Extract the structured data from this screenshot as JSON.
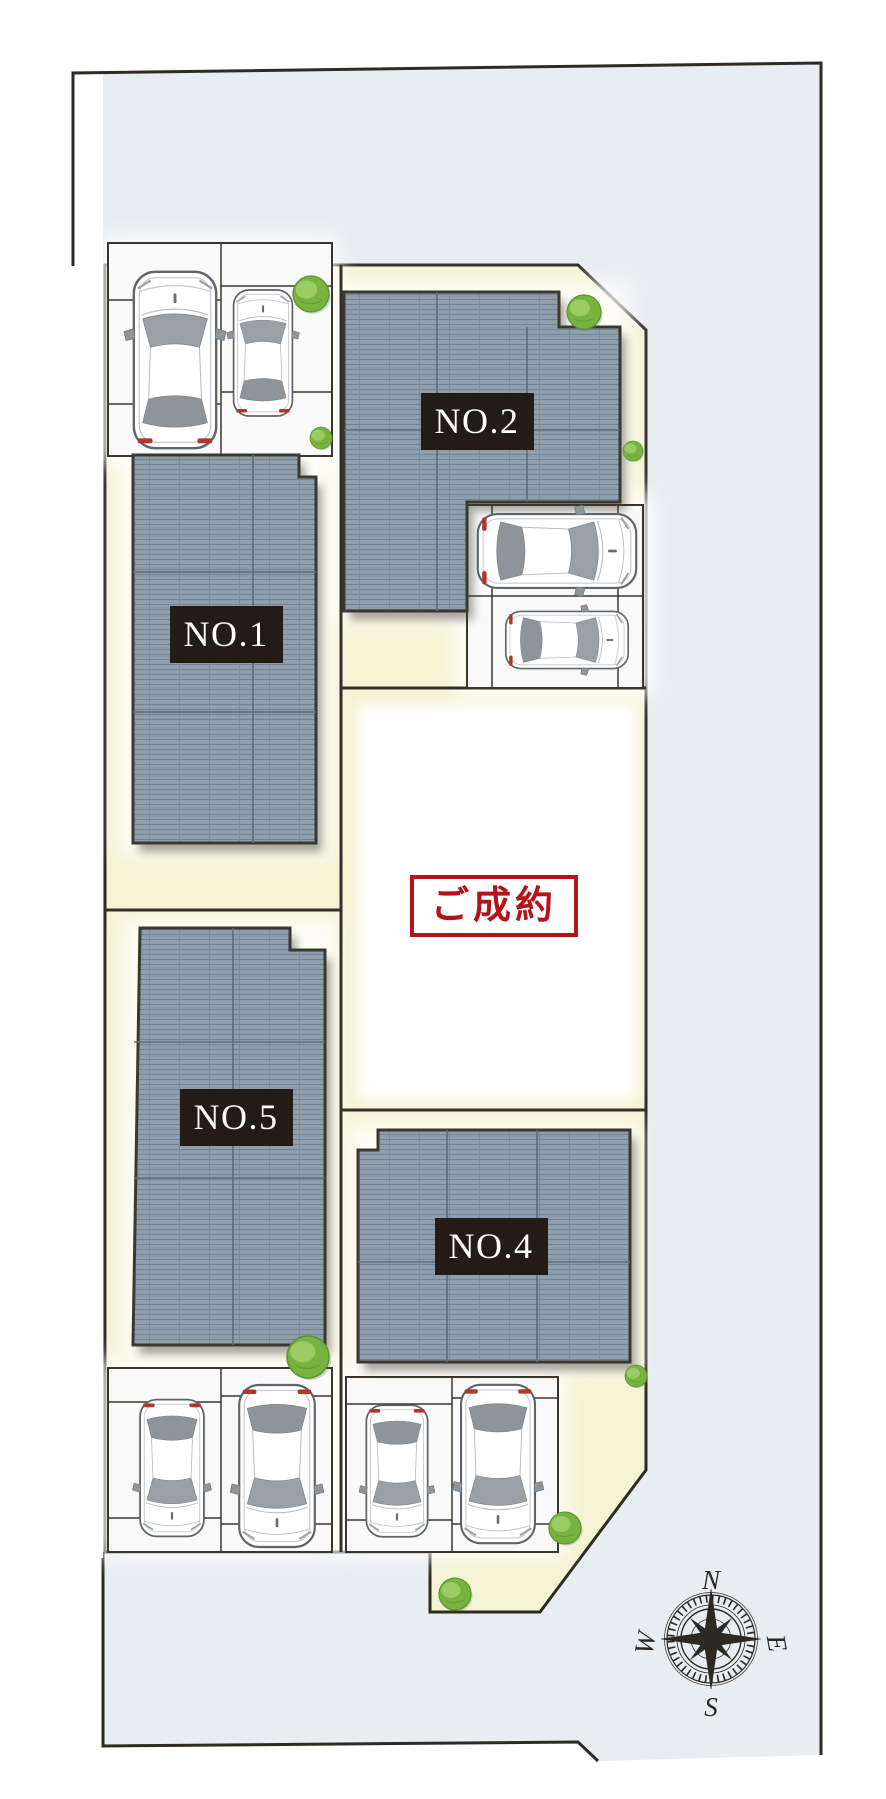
{
  "plan": {
    "lot_labels": {
      "no1": "NO.1",
      "no2": "NO.2",
      "no4": "NO.4",
      "no5": "NO.5"
    },
    "sold_label": "ご成約",
    "compass": {
      "north": "N",
      "south": "S",
      "east": "E",
      "west": "W"
    }
  },
  "colors": {
    "road": "#e8edf1",
    "site_ground": "#f4f3d4",
    "roof": "#8e9eac",
    "boundary": "#2e2a24",
    "label_bg": "#231b15",
    "label_text": "#ffffff",
    "stamp_red": "#b5121a",
    "tree_green": "#79b33f"
  }
}
